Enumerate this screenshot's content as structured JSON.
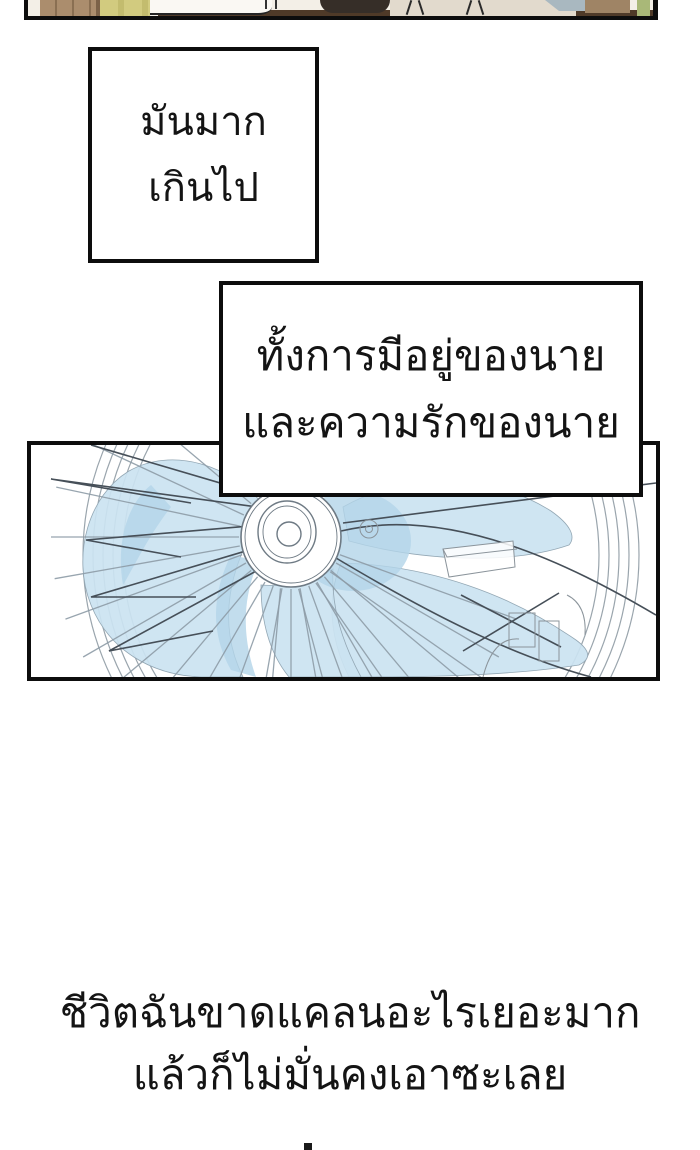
{
  "page": {
    "type": "comic-page",
    "background": "#ffffff"
  },
  "top_strip": {
    "description_colors": {
      "wood": "#ab8d6d",
      "yellow_cloth": "#d2cb7f",
      "blanket": "#faf8f3",
      "table_band": "#4f3a28",
      "dark_blob": "#362e28",
      "beige": "#e2dacd",
      "gray_blue": "#a9b8c0",
      "brown_block": "#9f8465",
      "green_strip": "#a9b878"
    }
  },
  "speech_boxes": [
    {
      "lines": [
        "มันมาก",
        "เกินไป"
      ]
    },
    {
      "lines": [
        "ทั้งการมีอยู่ของนาย",
        "และความรักของนาย"
      ]
    }
  ],
  "fan_panel": {
    "illustration": "fan-blades-technical-drawing",
    "colors": {
      "blade_blue": "#cbe3f1",
      "blade_blue_deep": "#b3d5e9",
      "line_gray": "#8d9ba6",
      "wire_dark": "#464f58",
      "border": "#0d0d0d"
    }
  },
  "caption": {
    "lines": [
      "ชีวิตฉันขาดแคลนอะไรเยอะมาก",
      "แล้วก็ไม่มั่นคงเอาซะเลย"
    ]
  }
}
